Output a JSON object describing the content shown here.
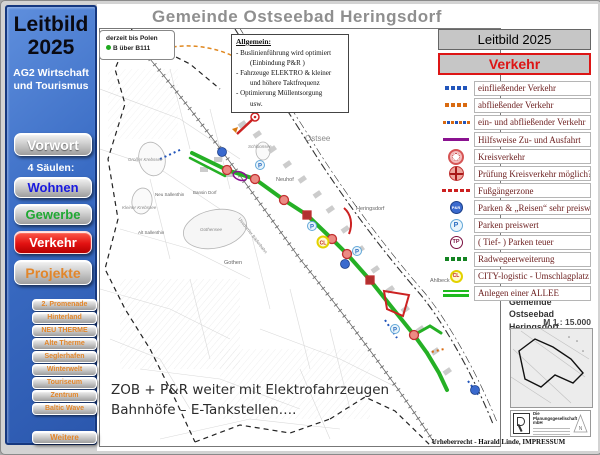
{
  "colors": {
    "sidebar_blue": "#3a6cc4",
    "verkehr_red": "#e21212",
    "projekte_orange": "#e2862a",
    "wohnen_blue": "#1a1adf",
    "gewerbe_green": "#1fa832",
    "legend_text_maroon": "#6b1d1d",
    "allee_green": "#1fbb1f",
    "map_title_gray": "#8f8f8f"
  },
  "sidebar": {
    "title_line1": "Leitbild",
    "title_line2": "2025",
    "subtitle": "AG2 Wirtschaft und Tourismus",
    "vorwort_label": "Vorwort",
    "saeulen_label": "4 Säulen:",
    "pillars": [
      {
        "label": "Wohnen"
      },
      {
        "label": "Gewerbe"
      },
      {
        "label": "Verkehr"
      },
      {
        "label": "Projekte"
      }
    ],
    "projects": [
      {
        "label": "2. Promenade"
      },
      {
        "label": "Hinterland"
      },
      {
        "label": "NEU THERME"
      },
      {
        "label": "Alte Therme"
      },
      {
        "label": "Seglerhafen"
      },
      {
        "label": "Winterwelt"
      },
      {
        "label": "Touriseum"
      },
      {
        "label": "Zentrum"
      },
      {
        "label": "Baltic Wave"
      }
    ],
    "weitere_label": "Weitere"
  },
  "map": {
    "title": "Gemeinde Ostseebad Heringsdorf",
    "info_box": {
      "line1": "derzeit bis Polen",
      "line2": "B über B111"
    },
    "allgemein": {
      "heading": "Allgemein:",
      "lines": [
        "- Buslinienführung wird optimiert",
        "(Einbindung P&R )",
        "- Fahrzeuge ELEKTRO & kleiner",
        "und höhere Taktfrequenz",
        "- Optimierung Müllentsorgung",
        "usw."
      ]
    },
    "note_line1": "ZOB + P&R weiter mit  Elektrofahrzeugen",
    "note_line2": "Bahnhöfe – E-Tankstellen….",
    "labels": [
      {
        "text": "Ostsee"
      },
      {
        "text": "Bansin"
      },
      {
        "text": "Schloonsee"
      },
      {
        "text": "Neuhof"
      },
      {
        "text": "Heringsdorf"
      },
      {
        "text": "Ahlbeck"
      },
      {
        "text": "Gothen"
      },
      {
        "text": "Gothensee"
      },
      {
        "text": "Großer Krebssee"
      },
      {
        "text": "Kleiner Krebssee"
      },
      {
        "text": "Neu Sallenthin"
      },
      {
        "text": "Bansin Dorf"
      },
      {
        "text": "Alt Sallenthin"
      },
      {
        "text": "Usedomer Bäderbahn"
      }
    ]
  },
  "legend": {
    "title": "Leitbild 2025",
    "subtitle": "Verkehr",
    "items": [
      {
        "label": "einfließender Verkehr",
        "icon": "blue-dots"
      },
      {
        "label": "abfließender Verkehr",
        "icon": "orange-dots"
      },
      {
        "label": "ein- und abfließender Verkehr",
        "icon": "mixed-dots"
      },
      {
        "label": "Hilfsweise Zu- und Ausfahrt",
        "icon": "purple-line"
      },
      {
        "label": "Kreisverkehr",
        "icon": "roundabout"
      },
      {
        "label": "Prüfung Kreisverkehr möglich?",
        "icon": "roundabout-check"
      },
      {
        "label": "Fußgängerzone",
        "icon": "red-dashes"
      },
      {
        "label": "Parken & „Reisen“ sehr preiswert",
        "icon": "pr-badge",
        "icon_label": "P&R"
      },
      {
        "label": "Parken preiswert",
        "icon": "p-badge",
        "icon_label": "P"
      },
      {
        "label": "( Tief- ) Parken teuer",
        "icon": "tp-badge",
        "icon_label": "TP"
      },
      {
        "label": "Radwegeerweiterung",
        "icon": "green-dots"
      },
      {
        "label": "CITY-logistic - Umschlagplatz",
        "icon": "cl-badge",
        "icon_label": "CL"
      },
      {
        "label": "Anlegen einer ALLEE",
        "icon": "allee-lines"
      }
    ]
  },
  "credits": {
    "gemeinde_line1": "Gemeinde",
    "gemeinde_line2": "Ostseebad Heringsdorf",
    "scale": "M 1 : 15.000",
    "firm_name": "Die Planungsgesellschaft mbH",
    "north_label": "N",
    "impressum": "Urheberrecht - Harald Linde, IMPRESSUM"
  }
}
